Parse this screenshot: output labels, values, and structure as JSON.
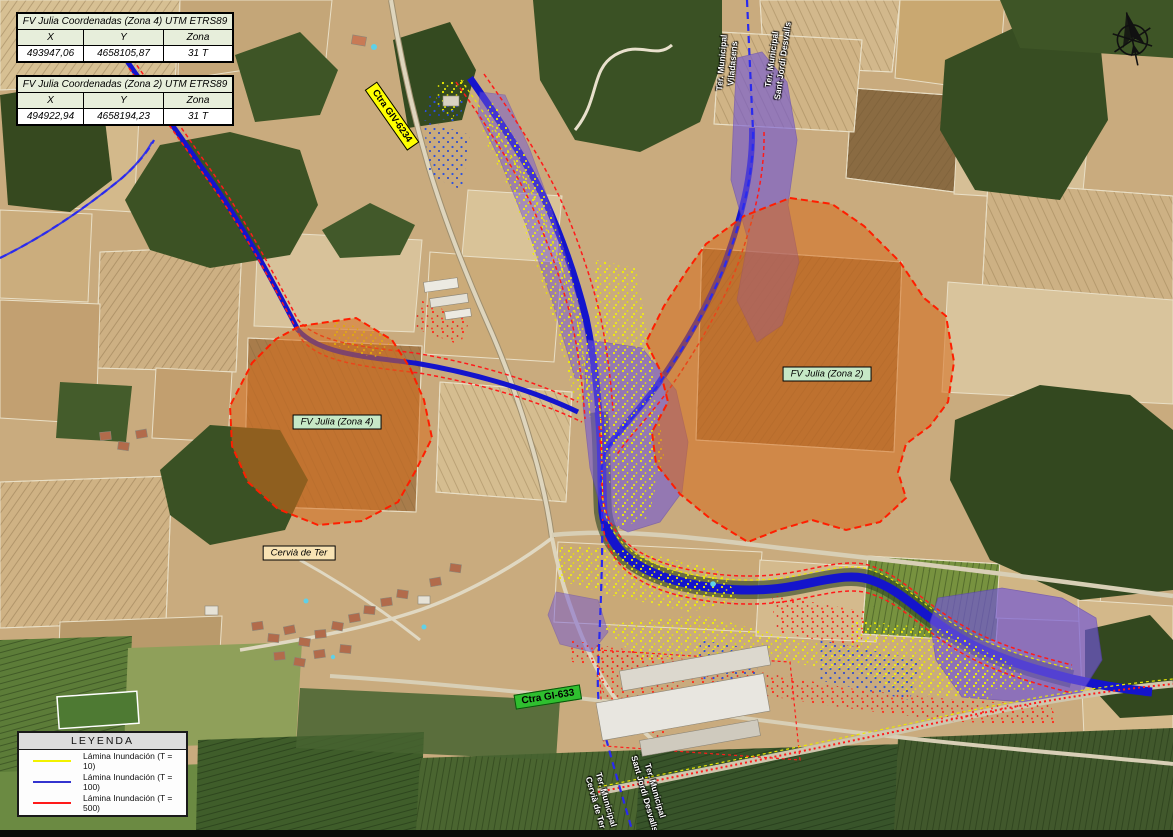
{
  "header_tables": [
    {
      "title": "FV Julia Coordenadas (Zona 4) UTM ETRS89",
      "headers": [
        "X",
        "Y",
        "Zona"
      ],
      "row": [
        "493947,06",
        "4658105,87",
        "31 T"
      ]
    },
    {
      "title": "FV Julia Coordenadas (Zona 2) UTM ETRS89",
      "headers": [
        "X",
        "Y",
        "Zona"
      ],
      "row": [
        "494922,94",
        "4658194,23",
        "31 T"
      ]
    }
  ],
  "map_labels": {
    "zone4": "FV Julia (Zona 4)",
    "zone2": "FV Julia (Zona 2)",
    "town": "Cervià de Ter",
    "road_giv": "Ctra GIV-6234",
    "road_gi": "Ctra GI-633"
  },
  "municipal_labels": {
    "top_left": "Ter. Municipal\nViladasens",
    "top_right": "Ter. Municipal\nSant Jordi Desvalls",
    "bottom_left": "Ter. Municipal\nCervià de Ter",
    "bottom_right": "Ter. Municipal\nSant Jordi Desvalls"
  },
  "legend": {
    "title": "LEYENDA",
    "items": [
      {
        "label": "Lámina Inundación (T = 10)",
        "color": "#f2f200"
      },
      {
        "label": "Lámina Inundación (T = 100)",
        "color": "#3434cf"
      },
      {
        "label": "Lámina Inundación (T = 500)",
        "color": "#ff1a1a"
      }
    ]
  },
  "icons": {
    "north_arrow": "north-arrow"
  },
  "colors": {
    "flood_t10": "#f2f200",
    "flood_t100_line": "#3434cf",
    "flood_t100_fill": "#7257d6",
    "flood_t500": "#ff1a1a",
    "zone_fill": "#d66c1c",
    "zone_outline": "#ff1e00",
    "municipal_boundary": "#2a2aee",
    "river": "#1414cc"
  }
}
